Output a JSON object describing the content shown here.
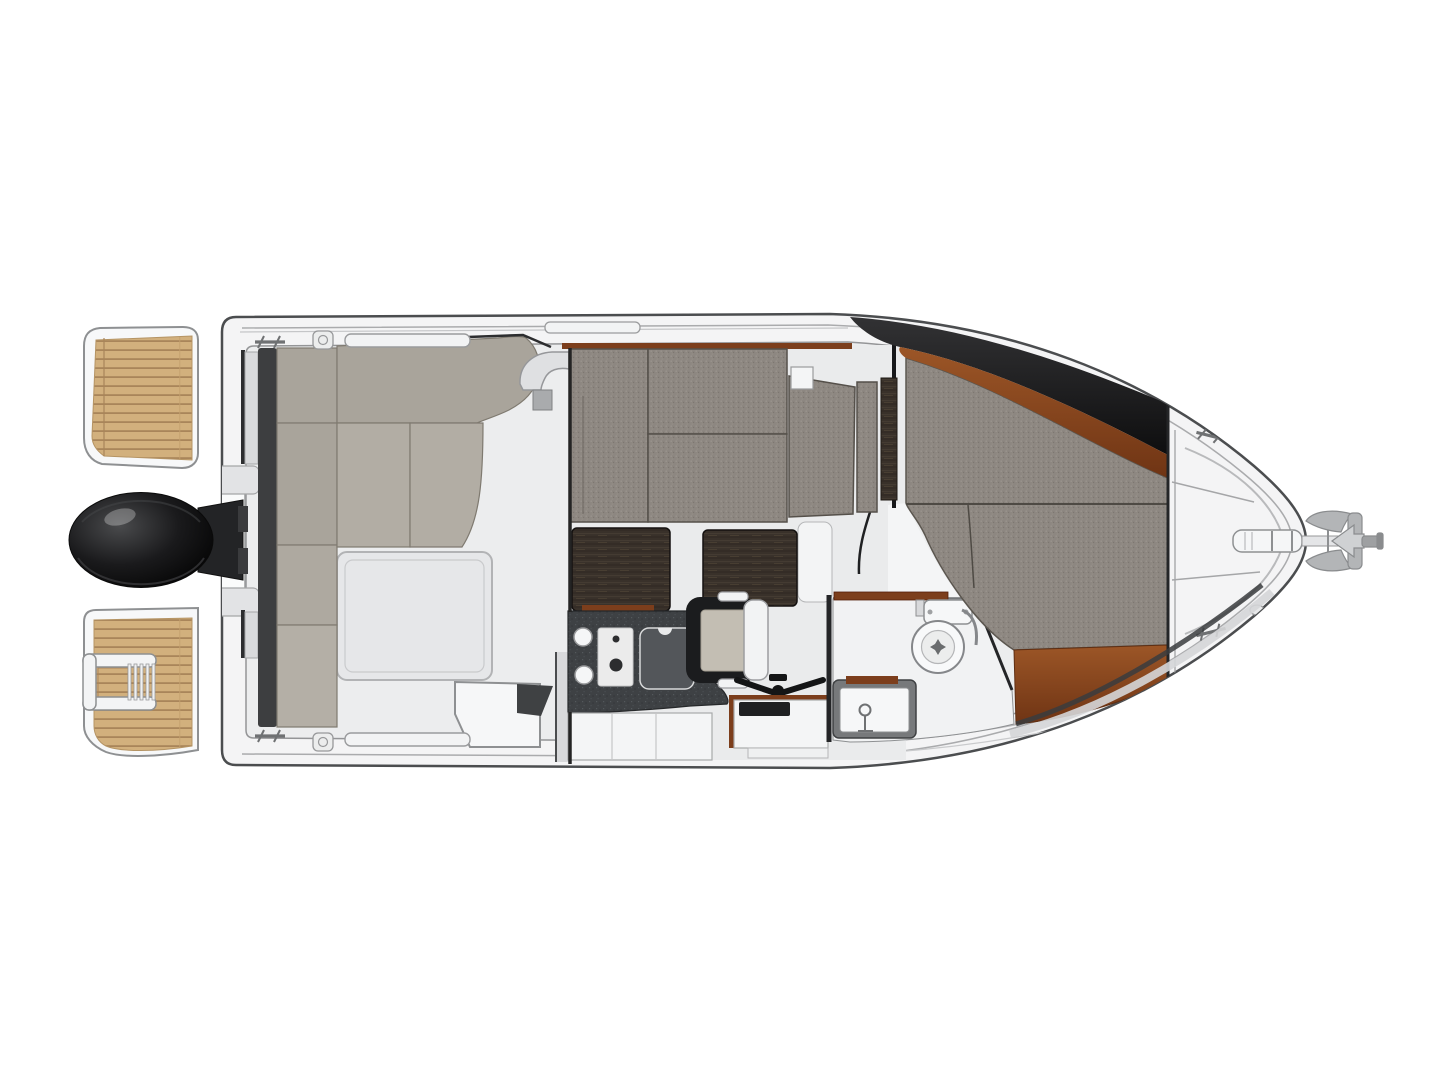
{
  "diagram": {
    "type": "boat-floor-plan",
    "view": "top-down",
    "subject": "motor cruiser deck and interior layout"
  },
  "colors": {
    "background": "#ffffff",
    "hull_fill": "#f4f4f5",
    "hull_outline": "#4b4d4f",
    "rubrail": "#aaabad",
    "deck_inner": "#ecedee",
    "platform_white": "#f7f8f9",
    "teak_base": "#d2b07d",
    "teak_stripe": "#a9855a",
    "teak_joint": "#c3a06c",
    "motor_hi": "#4a4b4d",
    "motor_mid": "#1a1a1c",
    "motor_dark": "#050505",
    "bracket_dark": "#232426",
    "backrest_dark": "#3d3e40",
    "cushion_taupe": "#a9a49b",
    "cushion_taupe_light": "#b2ada4",
    "cushion_seam": "#7f7a70",
    "tweed_base": "#8d8781",
    "tweed_light": "#9b958e",
    "tweed_dark": "#7d7770",
    "tweed_mid": "#948e87",
    "tweed_edge": "#55504a",
    "roof_light": "#323234",
    "roof_dark": "#0e0e0f",
    "mahogany_light": "#9c5627",
    "mahogany_dark": "#6f3414",
    "wood_trim": "#7c3e1c",
    "wenge_base": "#39312a",
    "wenge_streak1": "#473d33",
    "wenge_streak2": "#2d2620",
    "wenge_streak3": "#544838",
    "counter_base": "#3e4144",
    "counter_sp1": "#54585c",
    "counter_sp2": "#2f3235",
    "counter_sp3": "#4a4e52",
    "stove_white": "#ebebeb",
    "knob_dark": "#2c2d2f",
    "fixture_white": "#f5f6f7",
    "fixture_outline": "#8e9092",
    "seat_frame_black": "#1b1c1e",
    "seat_cushion": "#c3beb3",
    "shell_white": "#f2f3f4",
    "floor_light": "#f1f2f3",
    "hatch_fill": "#e6e7e9",
    "anchor_gray": "#b3b5b7",
    "line_gray": "#9a9b9d",
    "wall_dark": "#242527"
  }
}
